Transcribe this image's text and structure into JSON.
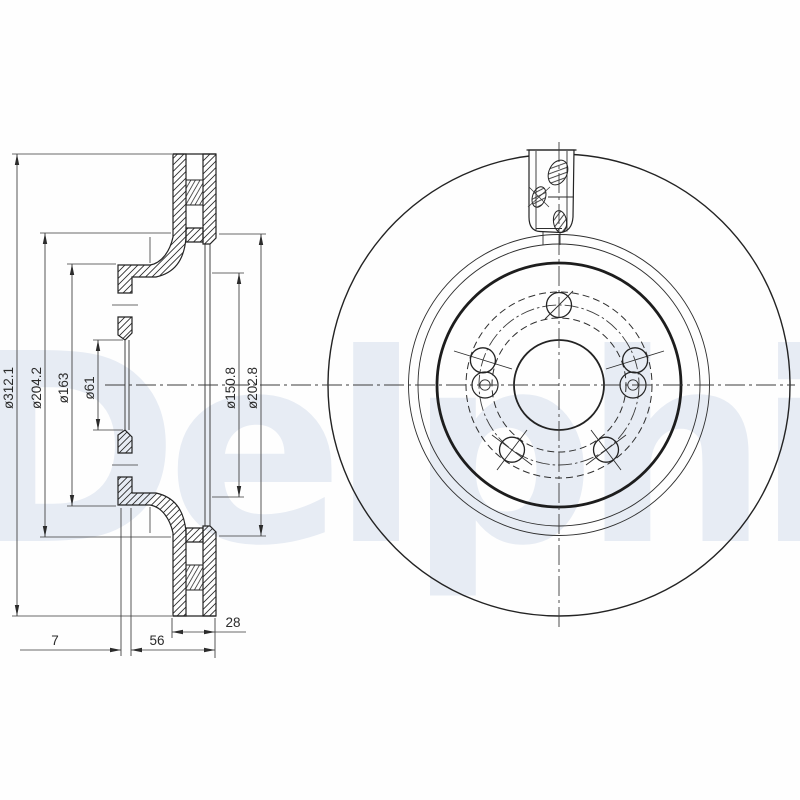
{
  "watermark": {
    "text": "Delphi",
    "color": "#e7ecf4"
  },
  "drawing": {
    "ink_color": "#232323",
    "type_label": "vented-brake-disc-technical-drawing",
    "dimensions": {
      "outer_diameter": "ø312.1",
      "inner_friction_diameter": "ø204.2",
      "hat_diameter": "ø163",
      "centre_bore_diameter": "ø61",
      "pilot_diameter": "ø150.8",
      "outer_friction_diameter": "ø202.8",
      "hat_offset": "7",
      "total_height": "56",
      "disc_thickness": "28"
    }
  }
}
